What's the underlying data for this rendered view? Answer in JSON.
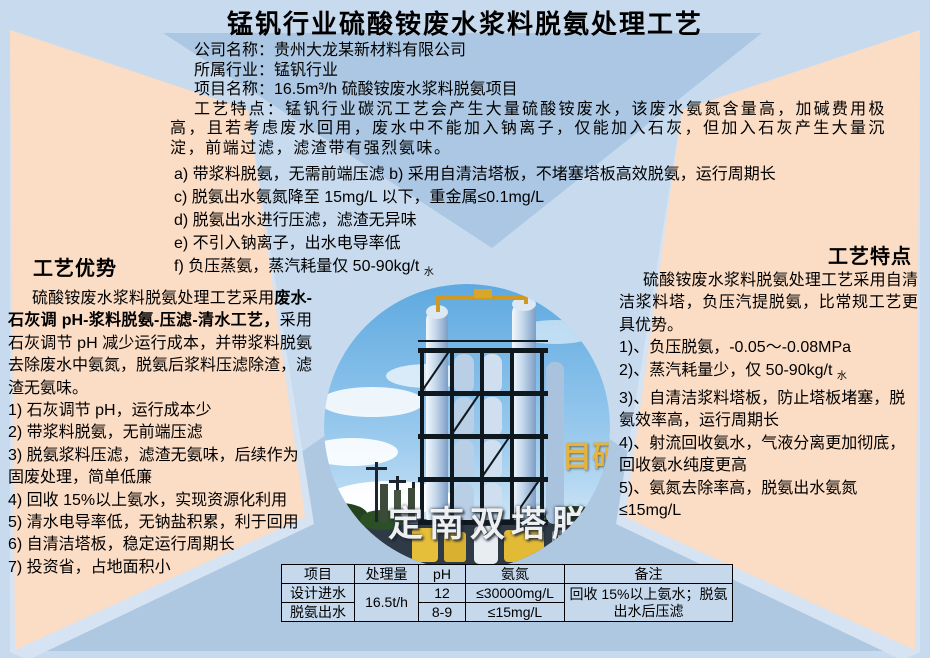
{
  "slide": {
    "title": "锰钒行业硫酸铵废水浆料脱氨处理工艺"
  },
  "info": {
    "company": "公司名称：贵州大龙某新材料有限公司",
    "industry": "所属行业：锰钒行业",
    "project": "项目名称：16.5m³/h 硫酸铵废水浆料脱氨项目",
    "paragraph": "工艺特点：锰钒行业碳沉工艺会产生大量硫酸铵废水，该废水氨氮含量高，加碱费用极高，且若考虑废水回用，废水中不能加入钠离子，仅能加入石灰，但加入石灰产生大量沉淀，前端过滤，滤渣带有强烈氨味。",
    "features": [
      "a) 带浆料脱氨，无需前端压滤 b) 采用自清洁塔板，不堵塞塔板高效脱氨，运行周期长",
      "c) 脱氨出水氨氮降至 15mg/L 以下，重金属≤0.1mg/L",
      "d) 脱氨出水进行压滤，滤渣无异味",
      "e) 不引入钠离子，出水电导率低"
    ],
    "feature_f_main": "f) 负压蒸氨，蒸汽耗量仅 50-90kg/t",
    "feature_f_sub": "水"
  },
  "left_panel": {
    "heading": "工艺优势",
    "para_pre": "硫酸铵废水浆料脱氨处理工艺采用",
    "para_bold": "废水-石灰调 pH-浆料脱氨-压滤-清水工艺，",
    "para_post": "采用石灰调节 pH 减少运行成本，并带浆料脱氨去除废水中氨氮，脱氨后浆料压滤除渣，滤渣无氨味。",
    "items": [
      "1) 石灰调节 pH，运行成本少",
      "2) 带浆料脱氨，无前端压滤",
      "3) 脱氨浆料压滤，滤渣无氨味，后续作为固废处理，简单低廉",
      "4) 回收 15%以上氨水，实现资源化利用",
      "5) 清水电导率低，无钠盐积累，利于回用",
      "6) 自清洁塔板，稳定运行周期长",
      "7) 投资省，占地面积小"
    ]
  },
  "right_panel": {
    "heading": "工艺特点",
    "para": "硫酸铵废水浆料脱氨处理工艺采用自清洁浆料塔，负压汽提脱氨，比常规工艺更具优势。",
    "item_1": "1)、负压脱氨，-0.05～-0.08MPa",
    "item_2_main": "2)、蒸汽耗量少，仅 50-90kg/t",
    "item_2_sub": "水",
    "item_3": "3)、自清洁浆料塔板，防止塔板堵塞，脱氨效率高，运行周期长",
    "item_4": "4)、射流回收氨水，气液分离更加彻底，回收氨水纯度更高",
    "item_5": "5)、氨氮去除率高，脱氨出水氨氮≤15mg/L"
  },
  "photo": {
    "caption": "定南双塔脱氨",
    "watermark": "目硕"
  },
  "table": {
    "headers": [
      "项目",
      "处理量",
      "pH",
      "氨氮",
      "备注"
    ],
    "rows": [
      {
        "item": "设计进水",
        "capacity": "16.5t/h",
        "ph": "12",
        "ammonia": "≤30000mg/L",
        "note": "回收 15%以上氨水；脱氨出水后压滤"
      },
      {
        "item": "脱氨出水",
        "ph": "8-9",
        "ammonia": "≤15mg/L"
      }
    ]
  },
  "colors": {
    "base": "#c8dbee",
    "panel_blue": "#abc7e3",
    "peach": "#fbdcc4",
    "table_bg": "#c6d9ec"
  }
}
